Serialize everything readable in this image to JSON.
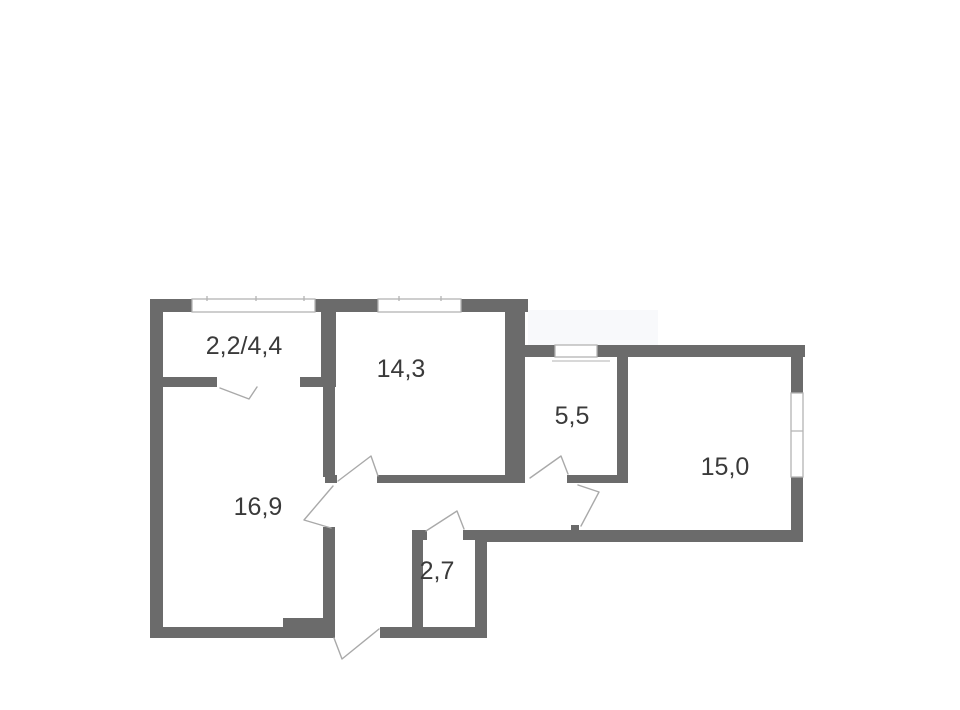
{
  "colors": {
    "wall": "#6b6b6b",
    "door_line": "#a9a9a9",
    "window_line": "#b4b4b4",
    "sill_line": "#cccccc",
    "label": "#3a3a3a",
    "background": "#ffffff"
  },
  "floor_plan": {
    "type": "apartment-floor-plan",
    "rooms": [
      {
        "position": "top-left-balcony",
        "area_label": "2,2/4,4"
      },
      {
        "position": "top-middle",
        "area_label": "14,3"
      },
      {
        "position": "middle-kitchen",
        "area_label": "5,5"
      },
      {
        "position": "right",
        "area_label": "15,0"
      },
      {
        "position": "left-large",
        "area_label": "16,9"
      },
      {
        "position": "bottom-small",
        "area_label": "2,7"
      }
    ],
    "window_count": 4,
    "door_count": 7
  }
}
